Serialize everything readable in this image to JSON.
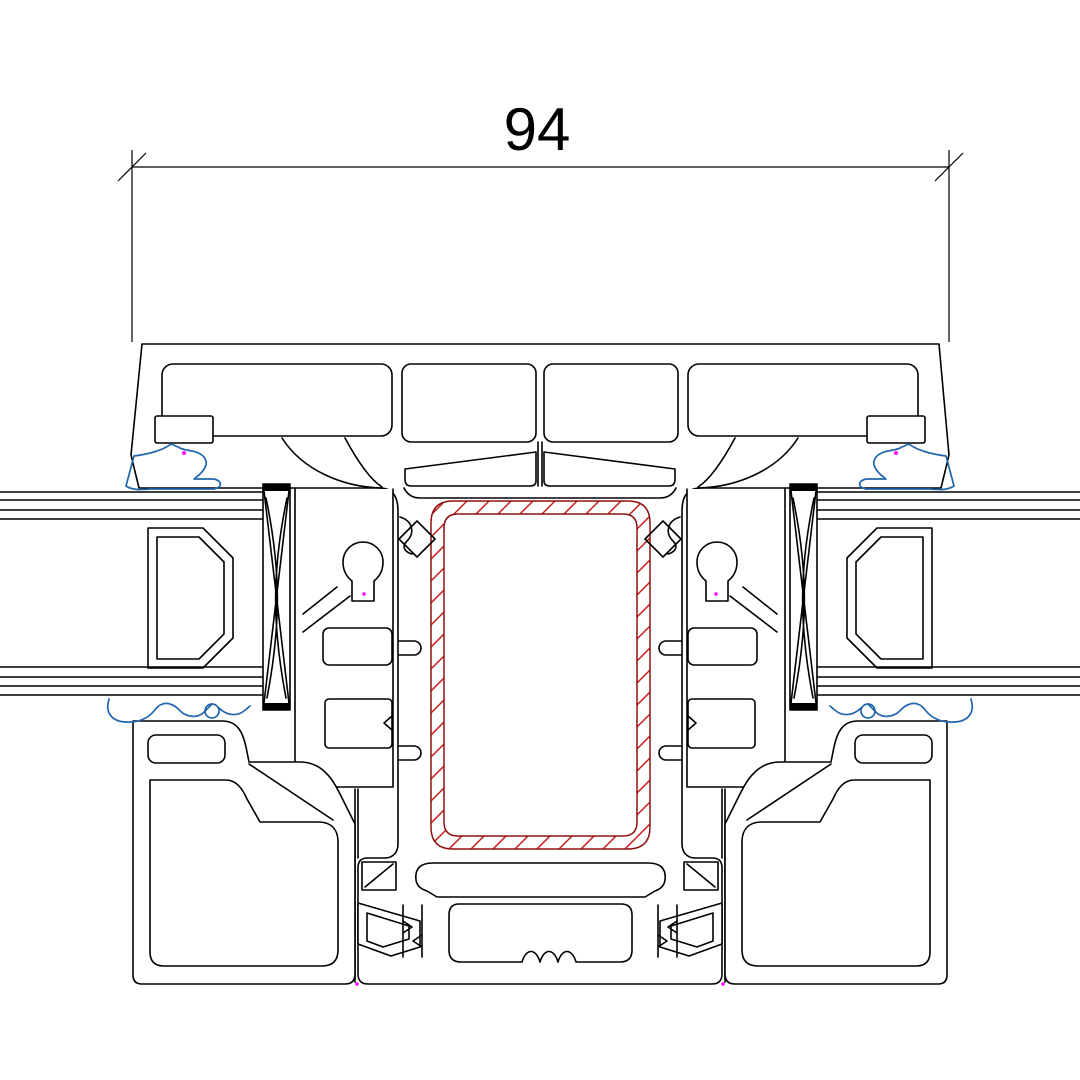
{
  "drawing": {
    "kind": "window-profile-cross-section",
    "dimension": {
      "value": "94"
    },
    "colors": {
      "line": "#000000",
      "steel_outline": "#8f1010",
      "steel_hatch": "#c41414",
      "gasket": "#2166ac",
      "marker": "#ff00ff",
      "background": "#ffffff"
    },
    "components": [
      "frame-profile",
      "central-mullion",
      "steel-reinforcement",
      "glazing-unit-left",
      "glazing-unit-right",
      "glazing-spacer",
      "glazing-packer",
      "sash-interlock",
      "sash-bottom-chamber",
      "gaskets"
    ]
  }
}
